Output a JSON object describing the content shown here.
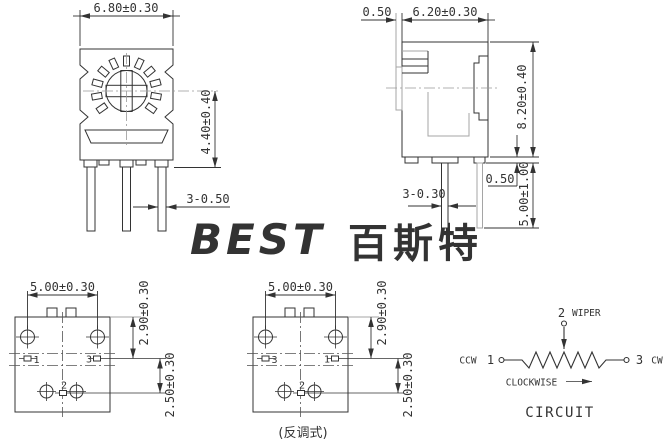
{
  "colors": {
    "line": "#333333",
    "grey": "#a5a5a5",
    "watermark_latin": "#c3ddf2",
    "watermark_cjk": "#c9e0f3"
  },
  "watermark": {
    "latin": "BEST",
    "cjk": "百斯特"
  },
  "front_view": {
    "width_dim": "6.80±0.30",
    "height_dim": "4.40±0.40",
    "pin_dim": "3-0.50"
  },
  "side_view": {
    "shaft_dim": "0.50",
    "width_dim": "6.20±0.30",
    "height_dim": "8.20±0.40",
    "standoff_dim": "0.50",
    "pin_length_dim": "5.00±1.00",
    "pin_dim": "3-0.30"
  },
  "bottom_standard": {
    "span_dim": "5.00±0.30",
    "upper_dim": "2.90±0.30",
    "lower_dim": "2.50±0.30",
    "pin_left": "1",
    "pin_right": "3",
    "pin_center": "2"
  },
  "bottom_reverse": {
    "span_dim": "5.00±0.30",
    "upper_dim": "2.90±0.30",
    "lower_dim": "2.50±0.30",
    "pin_left": "3",
    "pin_right": "1",
    "pin_center": "2",
    "caption": "(反调式)"
  },
  "circuit": {
    "wiper_pin": "2",
    "wiper_label": "WIPER",
    "left_label": "CCW",
    "left_pin": "1",
    "right_pin": "3",
    "right_label": "CW",
    "direction_label": "CLOCKWISE",
    "title": "CIRCUIT"
  }
}
